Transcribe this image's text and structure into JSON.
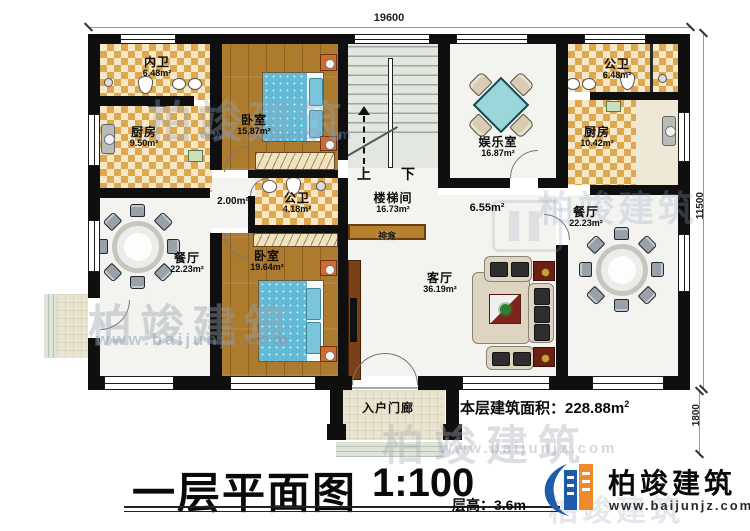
{
  "dimensions": {
    "width_top": "19600",
    "height_main": "11500",
    "height_porch": "1800"
  },
  "rooms": [
    {
      "name": "内卫",
      "area": "6.48m²"
    },
    {
      "name": "厨房",
      "area": "9.50m²"
    },
    {
      "name": "卧室",
      "area": "15.87m²"
    },
    {
      "name": "楼梯间",
      "area": "16.73m²"
    },
    {
      "name": "娱乐室",
      "area": "16.87m²"
    },
    {
      "name": "公卫",
      "area": "6.48m²"
    },
    {
      "name": "厨房",
      "area": "10.42m²"
    },
    {
      "name": "公卫",
      "area": "4.18m²"
    },
    {
      "name": "餐厅",
      "area": "22.23m²"
    },
    {
      "name": "卧室",
      "area": "19.64m²"
    },
    {
      "name": "客厅",
      "area": "36.19m²"
    },
    {
      "name": "餐厅",
      "area": "22.23m²"
    }
  ],
  "annotations": {
    "hall_small": "2.00m²",
    "hall_mid": "6.55m²",
    "up": "上",
    "down": "下",
    "shrine": "神龛",
    "porch": "入户门廊"
  },
  "summary": {
    "label": "本层建筑面积：",
    "value": "228.88m",
    "sup": "2"
  },
  "title_block": {
    "title": "一层平面图",
    "scale": "1:100",
    "floor_height": "层高：3.6m"
  },
  "brand": {
    "name": "柏竣建筑",
    "site": "www.baijunjz.com"
  },
  "watermark": {
    "name": "柏竣建筑",
    "site": "www.baijunjz.com"
  }
}
